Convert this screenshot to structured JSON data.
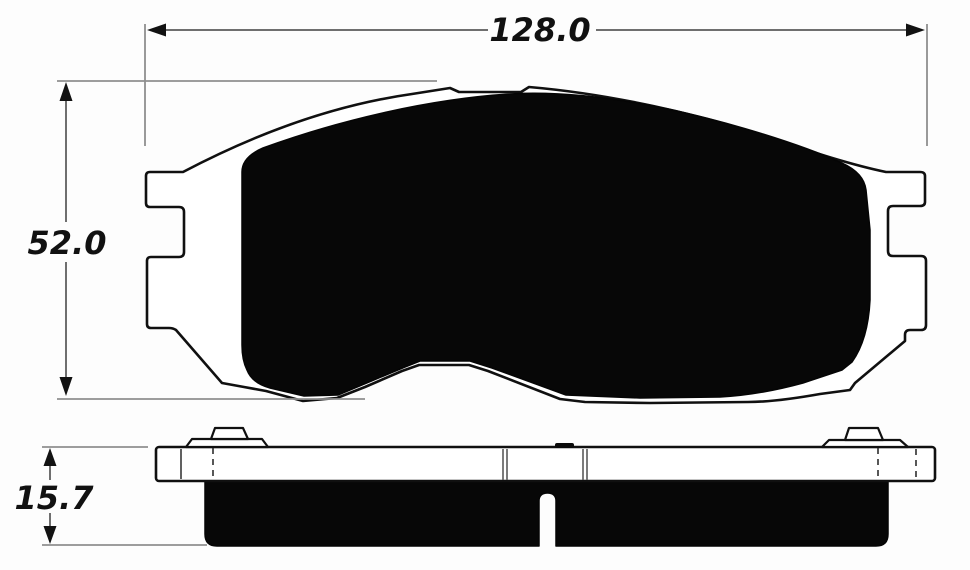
{
  "drawing": {
    "dimensions": {
      "width": "128.0",
      "height": "52.0",
      "thickness": "15.7"
    },
    "colors": {
      "background": "#fdfdfd",
      "outline": "#101010",
      "friction": "#070707",
      "dimension_line": "#6f6f6f",
      "extension_line": "#8f8f8f",
      "label_text": "#111111"
    }
  }
}
